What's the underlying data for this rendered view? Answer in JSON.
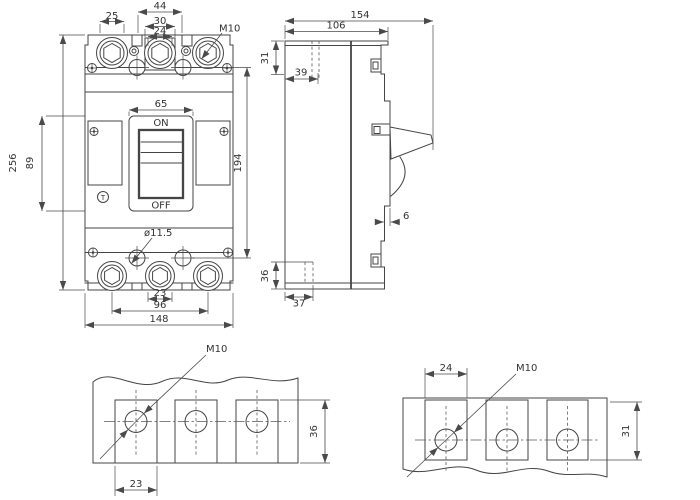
{
  "colors": {
    "line": "#454545",
    "dim_line": "#4a4a4a",
    "text": "#333333",
    "background": "#ffffff"
  },
  "front_view": {
    "dim_pole_width": "25",
    "dim_barrier_span": "44",
    "dim_terminal_block_width": "30",
    "dim_terminal_opening": "24",
    "terminal_thread_label": "M10",
    "dim_overall_height": "256",
    "dim_cover_height": "89",
    "dim_escutcheon_width": "65",
    "handle_on_label": "ON",
    "handle_off_label": "OFF",
    "trip_button_label": "T",
    "dim_mounting_hole_pitch": "194",
    "mounting_hole_label": "ø11.5",
    "dim_center_opening": "23",
    "dim_outer_pole_pitch": "96",
    "dim_overall_width": "148"
  },
  "side_view": {
    "dim_overall_depth": "154",
    "dim_body_depth": "106",
    "dim_top_recess_depth": "31",
    "dim_top_hole_offset": "39",
    "dim_step": "6",
    "dim_bottom_recess_depth": "36",
    "dim_bottom_hole_offset": "37"
  },
  "terminal_detail_front": {
    "thread_label": "M10",
    "dim_opening_width": "23",
    "dim_opening_height": "36"
  },
  "terminal_detail_side": {
    "dim_opening_width": "24",
    "thread_label": "M10",
    "dim_opening_height": "31"
  }
}
